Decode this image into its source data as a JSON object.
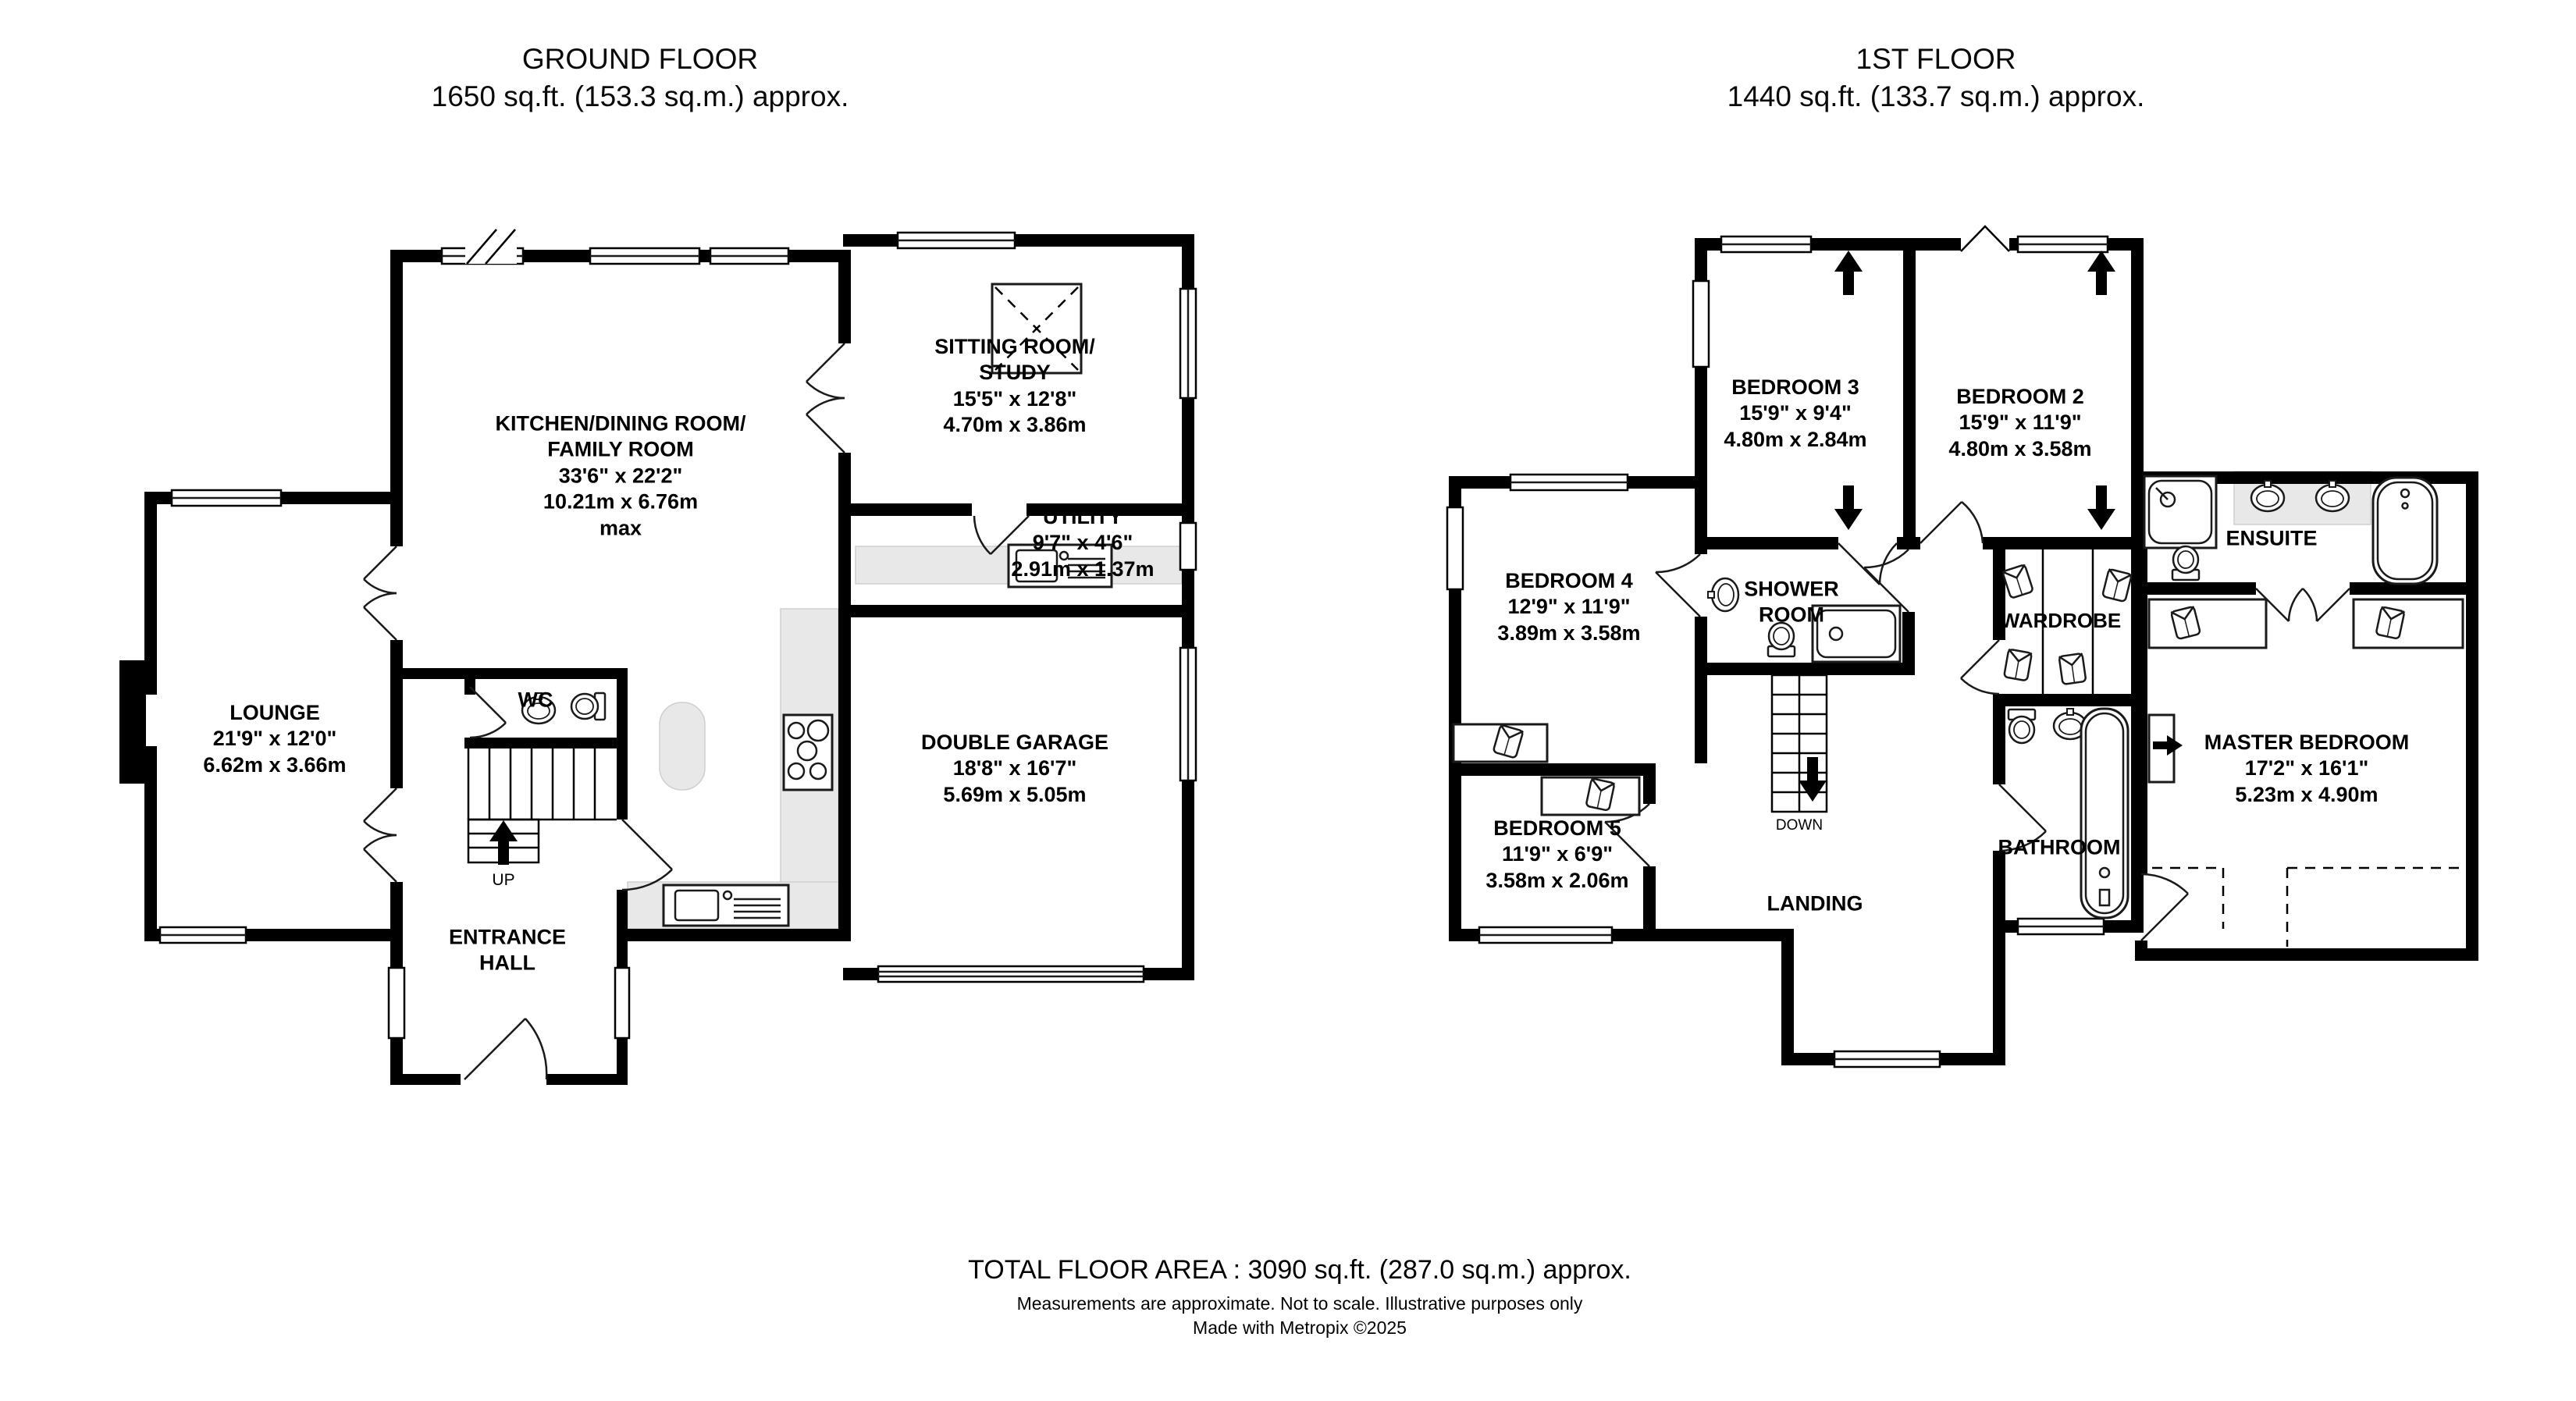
{
  "colors": {
    "wall": "#000000",
    "counter": "#e8e8e8",
    "background": "#ffffff"
  },
  "titles": {
    "ground": {
      "line1": "GROUND FLOOR",
      "line2": "1650 sq.ft. (153.3 sq.m.) approx."
    },
    "first": {
      "line1": "1ST FLOOR",
      "line2": "1440 sq.ft. (133.7 sq.m.) approx."
    }
  },
  "ground": {
    "kitchen": {
      "name1": "KITCHEN/DINING ROOM/",
      "name2": "FAMILY ROOM",
      "imperial": "33'6\"  x 22'2\"",
      "metric": "10.21m  x 6.76m",
      "note": "max"
    },
    "sitting": {
      "name1": "SITTING ROOM/",
      "name2": "STUDY",
      "imperial": "15'5\"  x 12'8\"",
      "metric": "4.70m  x 3.86m"
    },
    "utility": {
      "name": "UTILITY",
      "imperial": "9'7\"  x 4'6\"",
      "metric": "2.91m  x 1.37m"
    },
    "lounge": {
      "name": "LOUNGE",
      "imperial": "21'9\"  x 12'0\"",
      "metric": "6.62m  x 3.66m"
    },
    "garage": {
      "name": "DOUBLE GARAGE",
      "imperial": "18'8\"  x 16'7\"",
      "metric": "5.69m  x 5.05m"
    },
    "wc": {
      "name": "WC"
    },
    "entrance": {
      "name1": "ENTRANCE",
      "name2": "HALL"
    },
    "stairs": {
      "up": "UP"
    }
  },
  "first": {
    "bedroom3": {
      "name": "BEDROOM 3",
      "imperial": "15'9\"  x 9'4\"",
      "metric": "4.80m  x 2.84m"
    },
    "bedroom2": {
      "name": "BEDROOM 2",
      "imperial": "15'9\"  x 11'9\"",
      "metric": "4.80m  x 3.58m"
    },
    "bedroom4": {
      "name": "BEDROOM 4",
      "imperial": "12'9\"  x 11'9\"",
      "metric": "3.89m  x 3.58m"
    },
    "bedroom5": {
      "name": "BEDROOM 5",
      "imperial": "11'9\"  x 6'9\"",
      "metric": "3.58m  x 2.06m"
    },
    "shower": {
      "name1": "SHOWER",
      "name2": "ROOM"
    },
    "wardrobe": {
      "name": "WARDROBE"
    },
    "ensuite": {
      "name": "ENSUITE"
    },
    "master": {
      "name": "MASTER BEDROOM",
      "imperial": "17'2\"  x 16'1\"",
      "metric": "5.23m  x 4.90m"
    },
    "bathroom": {
      "name": "BATHROOM"
    },
    "landing": {
      "name": "LANDING"
    },
    "stairs": {
      "down": "DOWN"
    }
  },
  "footer": {
    "total": "TOTAL FLOOR AREA : 3090 sq.ft. (287.0 sq.m.) approx.",
    "disclaimer": "Measurements are approximate.  Not to scale.  Illustrative purposes only",
    "credit": "Made with Metropix ©2025"
  }
}
